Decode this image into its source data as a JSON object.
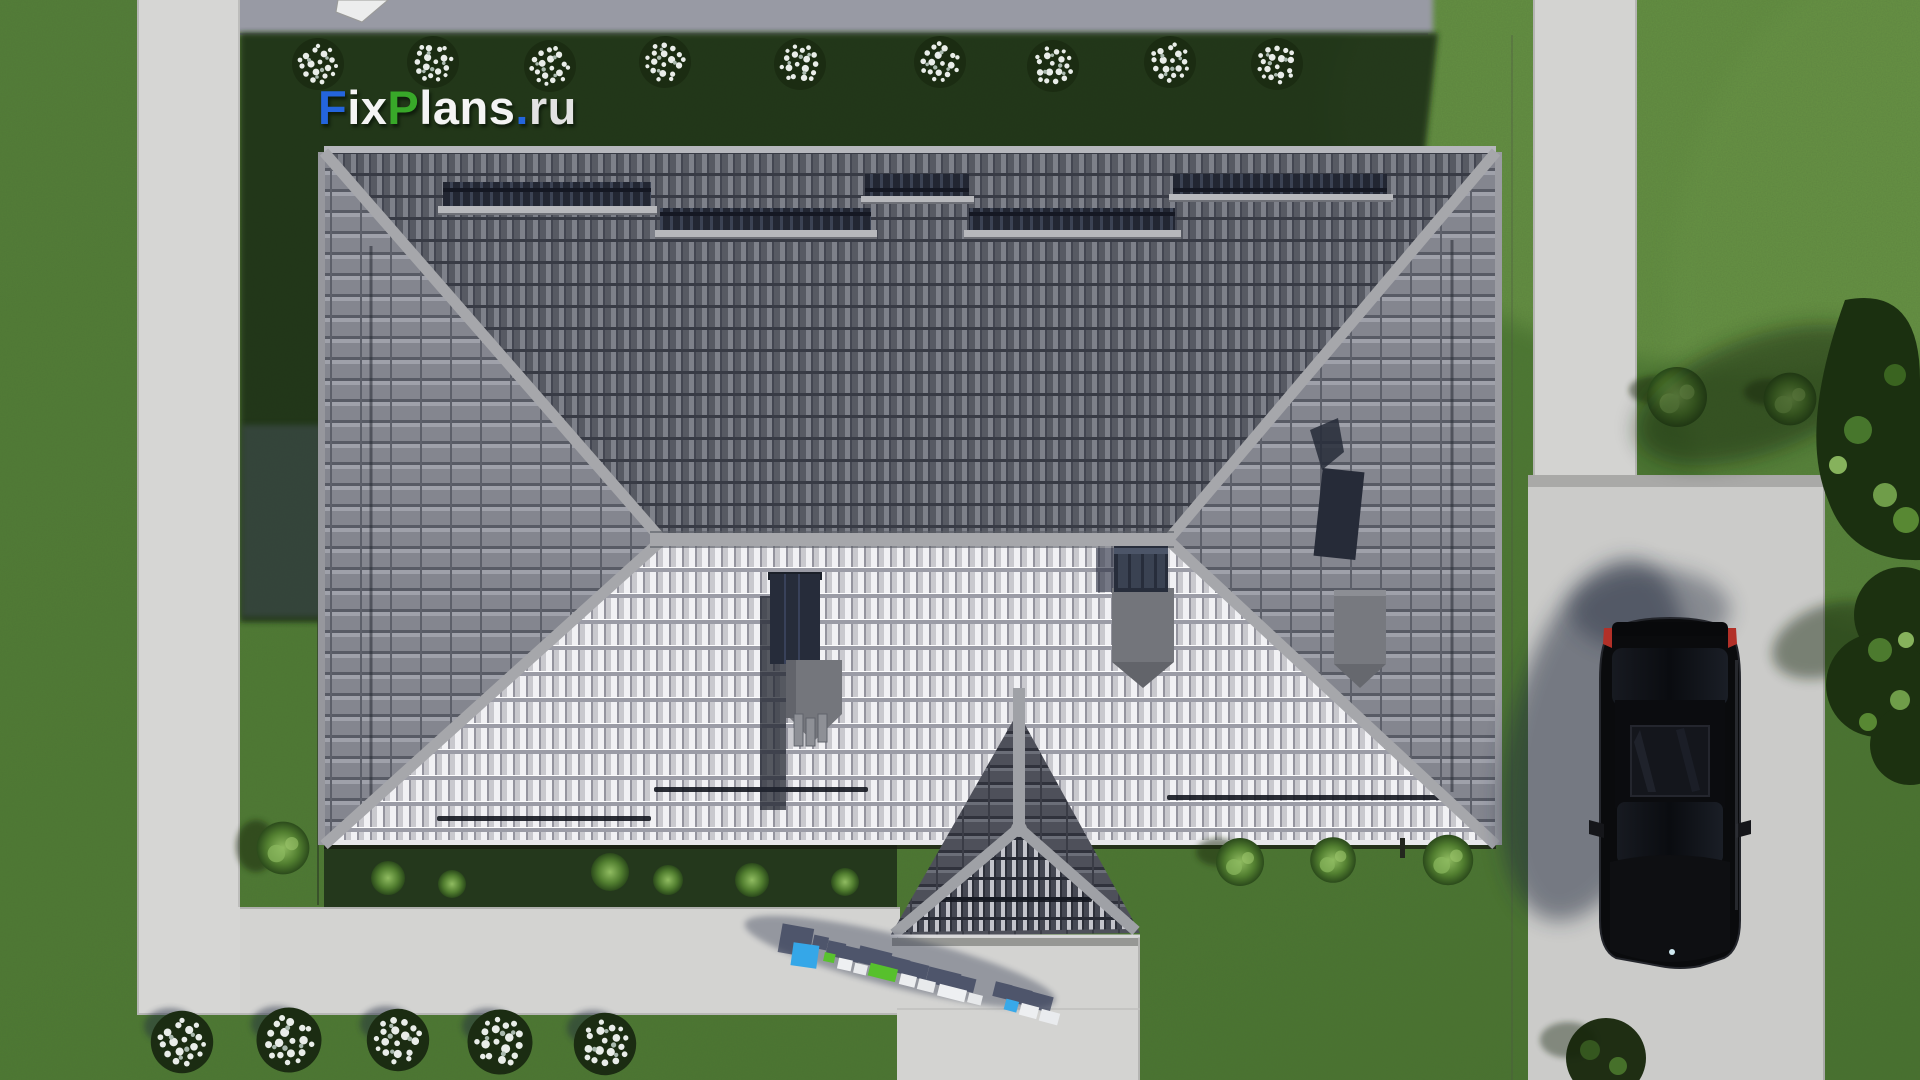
{
  "brand": {
    "logo_full": "FixPlans.ru",
    "segments": {
      "f": "F",
      "ix": "ix",
      "p": "P",
      "lans": "lans",
      "dot": ".",
      "ru": "ru"
    },
    "colors": {
      "blue": "#2465dd",
      "green": "#38a829",
      "white": "#f4f4f4"
    }
  },
  "watermarks": {
    "corner_logo": "FixPlans.ru",
    "ground_3d_text": "FixPlans.ru"
  },
  "scene": {
    "type": "aerial top-down 3D architectural render",
    "objects": {
      "house_roof": "hipped tile roof with gabled entrance porch",
      "roof_windows_count": 5,
      "snow_guard_bars_count": 4,
      "chimneys_count": 3,
      "car": "black car parked on driveway, facing south",
      "top_shrub_row_count": 9,
      "bottom_flower_bush_count": 5
    },
    "colors": {
      "lawn": "#4f7c35",
      "lawn_shadow": "#1c2f12",
      "path_concrete": "#d6d6d4",
      "driveway": "#cbcbc9",
      "roof_north_slope": "#575a63",
      "roof_south_slope": "#d9d9dd",
      "ridge_cap": "#a6a7ab",
      "car_body": "#0a0b0d"
    }
  }
}
